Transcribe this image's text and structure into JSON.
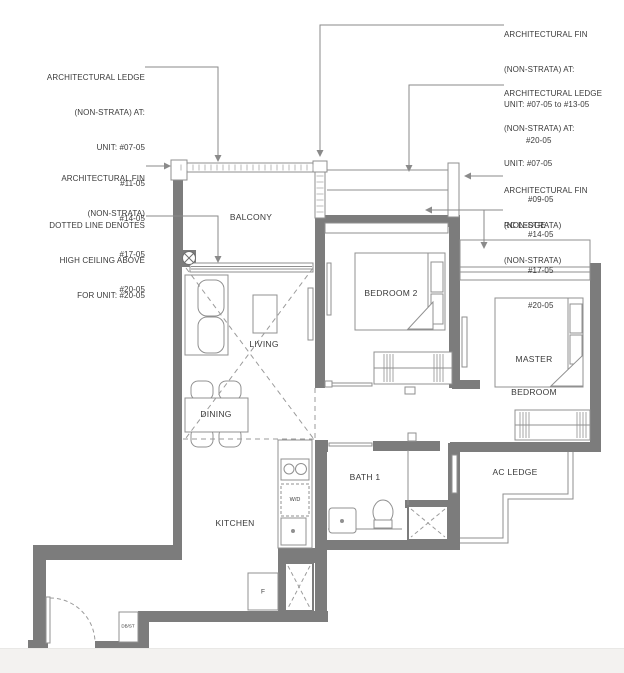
{
  "plan": {
    "rooms": {
      "balcony": "BALCONY",
      "living": "LIVING",
      "dining": "DINING",
      "kitchen": "KITCHEN",
      "bedroom2": "BEDROOM 2",
      "master_line1": "MASTER",
      "master_line2": "BEDROOM",
      "bath1": "BATH 1",
      "ac_ledge": "AC LEDGE"
    },
    "fixtures": {
      "washer_dryer": "W/D",
      "fridge": "F",
      "db_store": "DB/ST"
    },
    "annotations": {
      "arch_ledge_left": {
        "l0": "ARCHITECTURAL LEDGE",
        "l1": "(NON-STRATA) AT:",
        "l2": "UNIT: #07-05",
        "l3": "#11-05",
        "l4": "#14-05",
        "l5": "#17-05",
        "l6": "#20-05"
      },
      "arch_fin_left": {
        "l0": "ARCHITECTURAL FIN",
        "l1": "(NON-STRATA)"
      },
      "dotted_note": {
        "l0": "DOTTED LINE DENOTES",
        "l1": "HIGH CEILING ABOVE",
        "l2": "FOR UNIT: #20-05"
      },
      "arch_fin_top_right": {
        "l0": "ARCHITECTURAL FIN",
        "l1": "(NON-STRATA) AT:",
        "l2": "UNIT: #07-05 to #13-05",
        "l3": "#20-05"
      },
      "arch_ledge_right": {
        "l0": "ARCHITECTURAL LEDGE",
        "l1": "(NON-STRATA) AT:",
        "l2": "UNIT: #07-05",
        "l3": "#09-05",
        "l4": "#14-05",
        "l5": "#17-05",
        "l6": "#20-05"
      },
      "arch_fin_right": {
        "l0": "ARCHITECTURAL FIN",
        "l1": "(NON-STRATA)"
      },
      "rc_ledge": {
        "l0": "RC LEDGE",
        "l1": "(NON-STRATA)"
      }
    },
    "colors": {
      "wall": "#7c7c7c",
      "thin_line": "#8f8f8f",
      "dashed": "#9b9b9b",
      "text": "#3a3a3a",
      "footer": "#f3f2f0"
    }
  }
}
